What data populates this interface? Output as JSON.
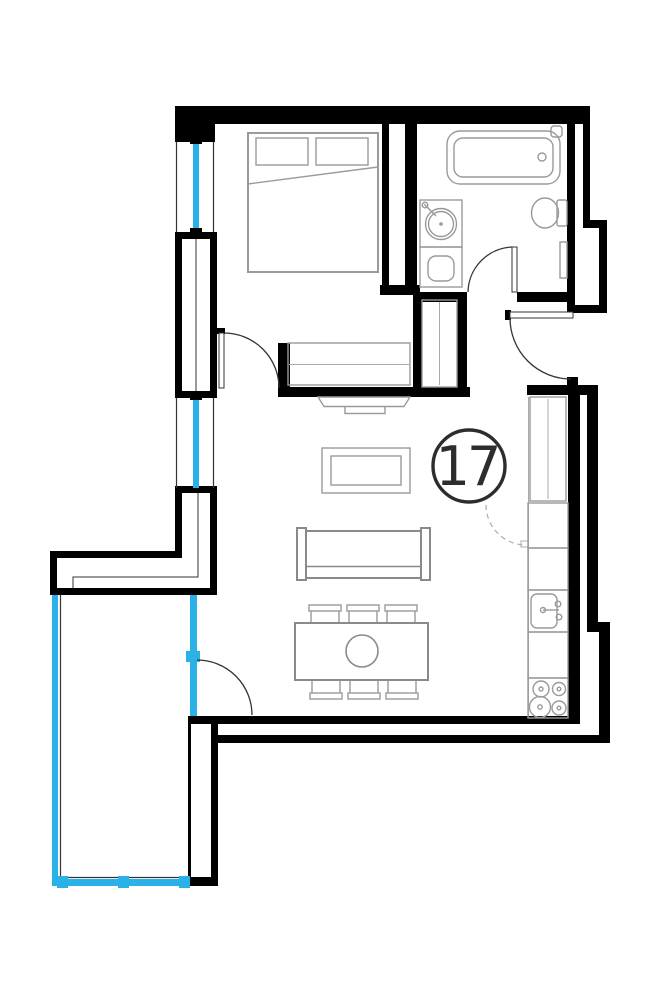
{
  "unit": {
    "number": "17"
  },
  "colors": {
    "wall": "#000000",
    "glazing": "#2ab2e8",
    "furniture": "#9a9a9a",
    "furniture_dark": "#8a8a8a",
    "hatch": "#ababab",
    "outline": "#333333",
    "label": "#2d2d2d",
    "background": "#ffffff"
  },
  "rooms": [
    {
      "name": "bedroom",
      "symbols": [
        "double-bed",
        "pillows",
        "wardrobe-hanging-rail",
        "swing-door"
      ]
    },
    {
      "name": "bathroom",
      "symbols": [
        "bathtub",
        "washbasin-counter",
        "washing-machine",
        "toilet",
        "radiator",
        "swing-door"
      ]
    },
    {
      "name": "hallway",
      "symbols": [
        "shelved-closet",
        "entry-swing-door"
      ]
    },
    {
      "name": "living-kitchen",
      "symbols": [
        "tv",
        "coffee-table",
        "sofa",
        "dining-table-6-chairs",
        "tall-cabinet",
        "kitchen-counter",
        "kitchen-sink",
        "stove-4-burners",
        "dashed-swing"
      ]
    },
    {
      "name": "balcony",
      "symbols": [
        "glazed-enclosure",
        "glazed-balcony-door"
      ]
    }
  ],
  "openings": {
    "windows": 2,
    "balcony_doors": 1,
    "entry_doors": 1,
    "interior_doors": 2
  }
}
